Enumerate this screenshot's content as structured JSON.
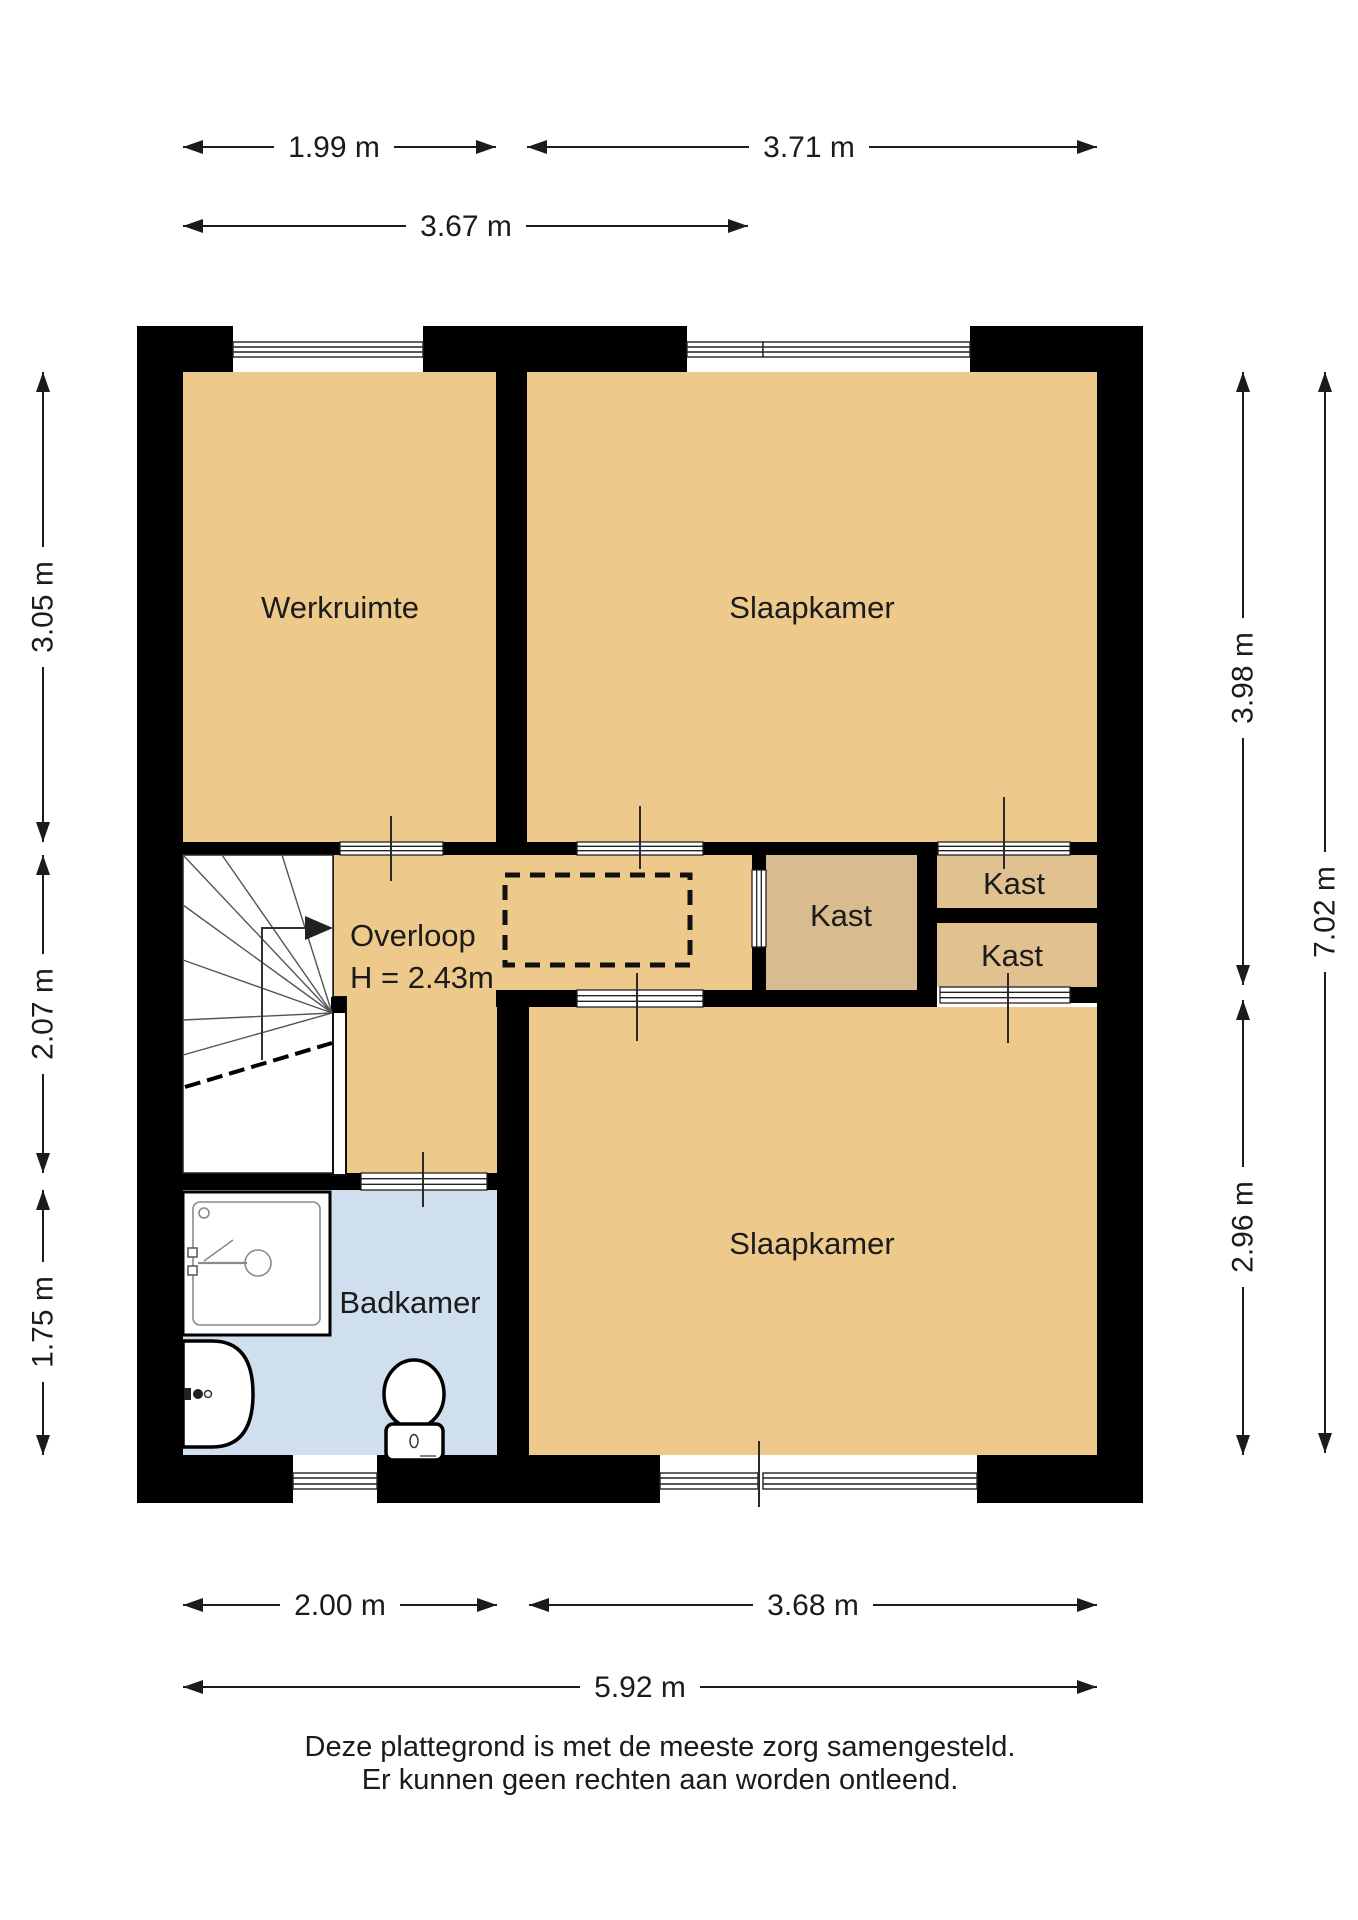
{
  "colors": {
    "wall": "#000000",
    "room": "#eec98c",
    "closet_mid": "#d8bb8f",
    "closet_right": "#e2c190",
    "bathroom": "#cfdfee",
    "stairs": "#ffffff",
    "glyph_line": "#222222"
  },
  "rooms": {
    "werkruimte": {
      "label": "Werkruimte"
    },
    "slaapkamer_top": {
      "label": "Slaapkamer"
    },
    "overloop": {
      "label": "Overloop",
      "height": "H = 2.43m"
    },
    "kast_mid": {
      "label": "Kast"
    },
    "kast_right_top": {
      "label": "Kast"
    },
    "kast_right_bottom": {
      "label": "Kast"
    },
    "slaapkamer_bottom": {
      "label": "Slaapkamer"
    },
    "badkamer": {
      "label": "Badkamer"
    }
  },
  "dimensions": {
    "top": [
      {
        "value": "1.99 m"
      },
      {
        "value": "3.71 m"
      },
      {
        "value": "3.67 m"
      }
    ],
    "left": [
      {
        "value": "3.05 m"
      },
      {
        "value": "2.07 m"
      },
      {
        "value": "1.75 m"
      }
    ],
    "right": [
      {
        "value": "3.98 m"
      },
      {
        "value": "7.02 m"
      },
      {
        "value": "2.96 m"
      }
    ],
    "bottom": [
      {
        "value": "2.00 m"
      },
      {
        "value": "3.68 m"
      },
      {
        "value": "5.92 m"
      }
    ]
  },
  "footer": {
    "line1": "Deze plattegrond is met de meeste zorg samengesteld.",
    "line2": "Er kunnen geen rechten aan worden ontleend."
  }
}
